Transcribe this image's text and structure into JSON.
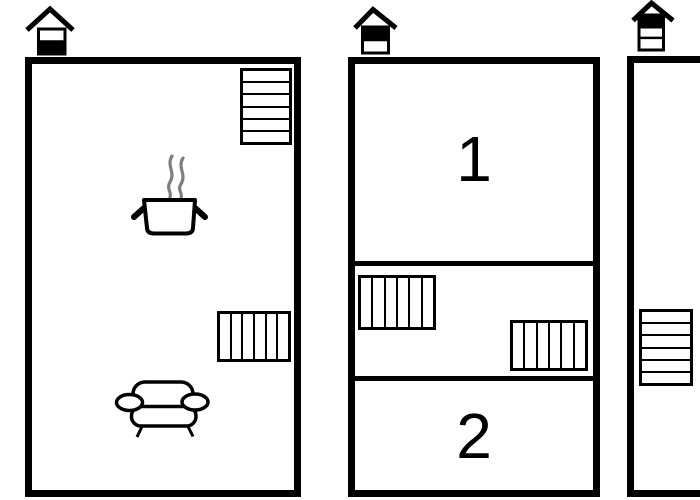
{
  "palette": {
    "background": "#ffffff",
    "line": "#000000",
    "steam": "#7f7f7f",
    "fill_white": "#ffffff",
    "fill_black": "#000000"
  },
  "houses": [
    {
      "id": "left",
      "bands": [
        "#ffffff",
        "#000000"
      ]
    },
    {
      "id": "middle",
      "bands": [
        "#000000",
        "#ffffff"
      ]
    },
    {
      "id": "right",
      "bands": [
        "#000000",
        "#ffffff",
        "#ffffff"
      ]
    }
  ],
  "rooms": {
    "left": {
      "radiators": [
        {
          "id": "top-right",
          "orientation": "horizontal",
          "fins": 6
        },
        {
          "id": "mid-right",
          "orientation": "vertical",
          "fins": 6
        }
      ],
      "furniture": [
        "cooking-pot-with-steam",
        "sofa"
      ]
    },
    "middle": {
      "sections": [
        {
          "label": "1"
        },
        {
          "radiators": [
            {
              "id": "left",
              "orientation": "vertical",
              "fins": 6
            },
            {
              "id": "right",
              "orientation": "vertical",
              "fins": 6
            }
          ]
        },
        {
          "label": "2"
        }
      ]
    },
    "right": {
      "radiators": [
        {
          "id": "left-wall",
          "orientation": "horizontal",
          "fins": 6
        }
      ]
    }
  }
}
